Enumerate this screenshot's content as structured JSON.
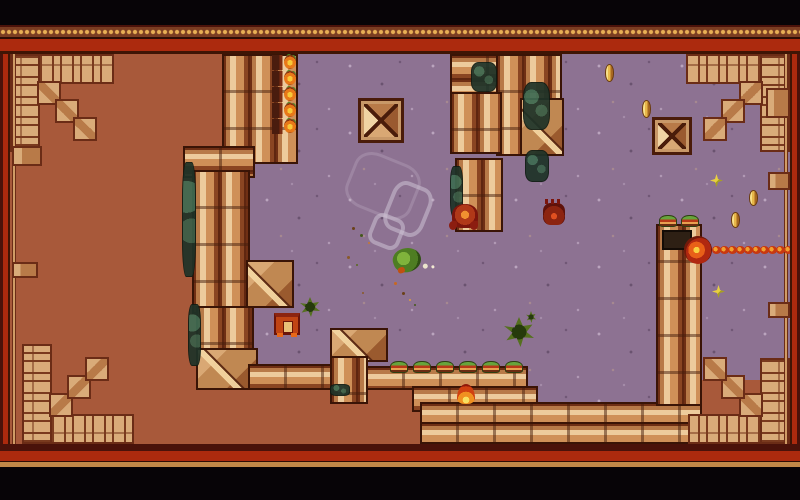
{
  "meta": {
    "kind": "game-screenshot",
    "description": "Top-down pixel-art dungeon arena: purple stone floor bordered by copper pipe walls and an ornamental rug frame, with enemies, coins, pickups and a chain-shooting gate turret.",
    "canvas": {
      "width": 800,
      "height": 500
    }
  },
  "palette": {
    "letterbox": "#070407",
    "frame_red": "#ac2a0e",
    "frame_maroon": "#4a120a",
    "frame_gold": "#c08848",
    "dot_gold": "#e8b055",
    "outside_brown": "#a8593a",
    "floor_purple": "#8d7292",
    "pipe_light": "#edcb9c",
    "pipe_mid": "#cf9058",
    "pipe_dark": "#6f2f14",
    "carpet_tan": "#d9ab79",
    "carpet_outline": "#6b2c16",
    "moss_teal": "#1f3328",
    "enemy_red": "#8c1d10",
    "player_green": "#4e7d22",
    "coin_gold": "#e8b84a",
    "chain_red": "#c83810"
  },
  "viewport": {
    "x": 10,
    "y": 54,
    "w": 780,
    "h": 390,
    "floor_clip": "polygon(286px 0px, 780px 0px, 780px 326px, 688px 326px, 688px 349px, 410px 349px, 410px 330px, 270px 330px, 270px 313px, 235px 313px, 235px 106px, 286px 106px)"
  },
  "frame_bands": {
    "top": [
      {
        "class": "letterbox",
        "y": 0,
        "h": 25
      },
      {
        "class": "band-maroon",
        "y": 25,
        "h": 2
      },
      {
        "class": "band-dots",
        "y": 27,
        "h": 10
      },
      {
        "class": "band-dark",
        "y": 37,
        "h": 2
      },
      {
        "class": "band-red",
        "y": 39,
        "h": 12
      },
      {
        "class": "band-edge",
        "y": 51,
        "h": 3
      }
    ],
    "bottom": [
      {
        "class": "band-maroon",
        "y": 444,
        "h": 7
      },
      {
        "class": "band-red",
        "y": 451,
        "h": 10
      },
      {
        "class": "band-dark",
        "y": 461,
        "h": 1
      },
      {
        "class": "band-gold",
        "y": 462,
        "h": 5
      },
      {
        "class": "letterbox",
        "y": 467,
        "h": 33
      }
    ],
    "left": [
      {
        "class": "band-maroon",
        "x": 0,
        "w": 3
      },
      {
        "class": "band-red",
        "x": 3,
        "w": 5
      },
      {
        "class": "band-edge",
        "x": 8,
        "w": 2
      }
    ],
    "right": [
      {
        "class": "band-edge",
        "x": 790,
        "w": 2
      },
      {
        "class": "band-red",
        "x": 792,
        "w": 5
      },
      {
        "class": "band-maroon",
        "x": 797,
        "w": 3
      }
    ]
  },
  "walls": [
    {
      "type": "v-pipe",
      "name": "wall-pillar-topleft",
      "x": 212,
      "y": 0,
      "w": 76,
      "h": 110
    },
    {
      "type": "h-pipe",
      "name": "wall-step-cap",
      "x": 173,
      "y": 92,
      "w": 72,
      "h": 32
    },
    {
      "type": "v-pipe",
      "name": "wall-left-column",
      "x": 182,
      "y": 116,
      "w": 58,
      "h": 144
    },
    {
      "type": "block-diag",
      "name": "wall-stub-right",
      "x": 236,
      "y": 206,
      "w": 48,
      "h": 48
    },
    {
      "type": "v-pipe",
      "name": "wall-left-column-2",
      "x": 186,
      "y": 252,
      "w": 58,
      "h": 50
    },
    {
      "type": "block-diag",
      "name": "wall-corner-block",
      "x": 186,
      "y": 294,
      "w": 62,
      "h": 42
    },
    {
      "type": "h-pipe",
      "name": "wall-hpipe-left",
      "x": 238,
      "y": 310,
      "w": 88,
      "h": 26
    },
    {
      "type": "block-diag",
      "name": "wall-bracket-arm",
      "x": 320,
      "y": 274,
      "w": 58,
      "h": 34
    },
    {
      "type": "v-pipe",
      "name": "wall-bracket-spine",
      "x": 320,
      "y": 302,
      "w": 38,
      "h": 48
    },
    {
      "type": "h-pipe",
      "name": "wall-hpipe-mid",
      "x": 356,
      "y": 312,
      "w": 162,
      "h": 24
    },
    {
      "type": "h-pipe",
      "name": "wall-lower-cluster",
      "x": 402,
      "y": 332,
      "w": 126,
      "h": 26
    },
    {
      "type": "h-pipe",
      "name": "wall-bottom-row-1",
      "x": 410,
      "y": 348,
      "w": 282,
      "h": 22
    },
    {
      "type": "h-pipe",
      "name": "wall-bottom-row-2",
      "x": 410,
      "y": 368,
      "w": 282,
      "h": 22
    },
    {
      "type": "h-pipe",
      "name": "wall-topright-a",
      "x": 440,
      "y": 0,
      "w": 112,
      "h": 46
    },
    {
      "type": "v-pipe",
      "name": "wall-topright-b",
      "x": 486,
      "y": 0,
      "w": 66,
      "h": 102
    },
    {
      "type": "v-pipe",
      "name": "wall-topright-c",
      "x": 440,
      "y": 38,
      "w": 52,
      "h": 62
    },
    {
      "type": "v-pipe",
      "name": "wall-topright-stub",
      "x": 445,
      "y": 104,
      "w": 48,
      "h": 74
    },
    {
      "type": "block-diag",
      "name": "wall-topright-d",
      "x": 510,
      "y": 44,
      "w": 44,
      "h": 58
    },
    {
      "type": "v-pipe",
      "name": "gate-tower",
      "x": 646,
      "y": 170,
      "w": 46,
      "h": 182
    },
    {
      "type": "crate",
      "name": "pyramid-crate-1",
      "x": 348,
      "y": 44,
      "w": 46,
      "h": 45
    },
    {
      "type": "crate",
      "name": "pyramid-crate-2",
      "x": 642,
      "y": 63,
      "w": 40,
      "h": 38
    }
  ],
  "decor": {
    "corners": [
      {
        "name": "carpet-corner-topleft",
        "x": 0,
        "y": 0,
        "w": 104,
        "h": 98,
        "flip": ""
      },
      {
        "name": "carpet-corner-topright",
        "x": 676,
        "y": 0,
        "w": 104,
        "h": 98,
        "flip": "flip-x"
      },
      {
        "name": "carpet-corner-bottomleft",
        "x": 12,
        "y": 290,
        "w": 112,
        "h": 100,
        "flip": "flip-y"
      },
      {
        "name": "carpet-corner-bottomright",
        "x": 678,
        "y": 304,
        "w": 102,
        "h": 86,
        "flip": "flip-xy"
      }
    ],
    "trims": [
      {
        "kind": "line",
        "name": "carpet-trim-left",
        "x": 3,
        "y": 0,
        "w": 2,
        "h": 390
      },
      {
        "kind": "line",
        "name": "carpet-trim-right",
        "x": 775,
        "y": 0,
        "w": 2,
        "h": 390
      },
      {
        "kind": "box",
        "name": "carpet-ornament",
        "x": 2,
        "y": 92,
        "w": 30,
        "h": 20
      },
      {
        "kind": "box",
        "name": "carpet-ornament",
        "x": 2,
        "y": 208,
        "w": 26,
        "h": 16
      },
      {
        "kind": "box",
        "name": "carpet-ornament",
        "x": 756,
        "y": 34,
        "w": 24,
        "h": 30
      },
      {
        "kind": "box",
        "name": "carpet-ornament",
        "x": 758,
        "y": 118,
        "w": 22,
        "h": 18
      },
      {
        "kind": "box",
        "name": "carpet-ornament",
        "x": 758,
        "y": 248,
        "w": 22,
        "h": 16
      }
    ],
    "moss": [
      {
        "name": "moss-patch",
        "x": 172,
        "y": 108,
        "w": 14,
        "h": 115
      },
      {
        "name": "moss-patch",
        "x": 178,
        "y": 250,
        "w": 13,
        "h": 62
      },
      {
        "name": "moss-patch",
        "x": 461,
        "y": 8,
        "w": 26,
        "h": 30
      },
      {
        "name": "moss-patch",
        "x": 513,
        "y": 28,
        "w": 27,
        "h": 48
      },
      {
        "name": "moss-patch",
        "x": 440,
        "y": 112,
        "w": 13,
        "h": 52
      },
      {
        "name": "moss-patch",
        "x": 515,
        "y": 96,
        "w": 24,
        "h": 32
      },
      {
        "name": "moss-patch",
        "x": 320,
        "y": 330,
        "w": 20,
        "h": 12
      }
    ]
  },
  "entities": [
    {
      "type": "ring faint",
      "name": "smoke-ring-large",
      "x": 338,
      "y": 103,
      "w": 70,
      "h": 58
    },
    {
      "type": "ring",
      "name": "smoke-ring-mid",
      "x": 377,
      "y": 129,
      "w": 42,
      "h": 52
    },
    {
      "type": "ring",
      "name": "smoke-ring-small",
      "x": 360,
      "y": 161,
      "w": 33,
      "h": 33
    },
    {
      "type": "player",
      "name": "player-character",
      "x": 383,
      "y": 194,
      "w": 28,
      "h": 24
    },
    {
      "type": "crab",
      "name": "crab-enemy-1",
      "x": 442,
      "y": 150,
      "w": 26,
      "h": 24
    },
    {
      "type": "crab2",
      "name": "crab-enemy-2",
      "x": 533,
      "y": 149,
      "w": 22,
      "h": 22
    },
    {
      "type": "flame",
      "name": "flame-enemy",
      "x": 447,
      "y": 330,
      "w": 18,
      "h": 20
    },
    {
      "type": "chest",
      "name": "spawner-hut",
      "x": 264,
      "y": 259,
      "w": 26,
      "h": 22
    },
    {
      "type": "splat",
      "name": "green-splat-1",
      "x": 290,
      "y": 243,
      "w": 20,
      "h": 20
    },
    {
      "type": "splat",
      "name": "green-splat-2",
      "x": 494,
      "y": 263,
      "w": 30,
      "h": 30
    },
    {
      "type": "splat",
      "name": "green-splat-2b",
      "x": 516,
      "y": 257,
      "w": 10,
      "h": 12
    },
    {
      "type": "torch",
      "name": "wall-torch",
      "x": 262,
      "y": 1,
      "w": 24,
      "h": 15
    },
    {
      "type": "torch",
      "name": "wall-torch",
      "x": 262,
      "y": 17,
      "w": 24,
      "h": 15
    },
    {
      "type": "torch",
      "name": "wall-torch",
      "x": 262,
      "y": 33,
      "w": 24,
      "h": 15
    },
    {
      "type": "torch",
      "name": "wall-torch",
      "x": 262,
      "y": 49,
      "w": 24,
      "h": 15
    },
    {
      "type": "torch",
      "name": "wall-torch",
      "x": 262,
      "y": 65,
      "w": 24,
      "h": 15
    },
    {
      "type": "cap",
      "name": "pipe-cap",
      "x": 380,
      "y": 307,
      "w": 18,
      "h": 12
    },
    {
      "type": "cap",
      "name": "pipe-cap",
      "x": 403,
      "y": 307,
      "w": 18,
      "h": 12
    },
    {
      "type": "cap",
      "name": "pipe-cap",
      "x": 426,
      "y": 307,
      "w": 18,
      "h": 12
    },
    {
      "type": "cap",
      "name": "pipe-cap",
      "x": 449,
      "y": 307,
      "w": 18,
      "h": 12
    },
    {
      "type": "cap",
      "name": "pipe-cap",
      "x": 472,
      "y": 307,
      "w": 18,
      "h": 12
    },
    {
      "type": "cap",
      "name": "pipe-cap",
      "x": 495,
      "y": 307,
      "w": 18,
      "h": 12
    },
    {
      "type": "cap",
      "name": "tower-cap",
      "x": 649,
      "y": 161,
      "w": 18,
      "h": 12
    },
    {
      "type": "cap",
      "name": "tower-cap",
      "x": 671,
      "y": 161,
      "w": 18,
      "h": 12
    },
    {
      "type": "panel",
      "name": "tower-vent",
      "x": 652,
      "y": 176,
      "w": 30,
      "h": 20
    },
    {
      "type": "gate",
      "name": "chain-gate-turret",
      "x": 674,
      "y": 182,
      "w": 28,
      "h": 28
    },
    {
      "type": "chain-link",
      "name": "chain-link",
      "x": 702,
      "y": 192,
      "w": 9,
      "h": 8
    },
    {
      "type": "chain-link",
      "name": "chain-link",
      "x": 710,
      "y": 192,
      "w": 9,
      "h": 8
    },
    {
      "type": "chain-link",
      "name": "chain-link",
      "x": 718,
      "y": 192,
      "w": 9,
      "h": 8
    },
    {
      "type": "chain-link",
      "name": "chain-link",
      "x": 726,
      "y": 192,
      "w": 9,
      "h": 8
    },
    {
      "type": "chain-link",
      "name": "chain-link",
      "x": 734,
      "y": 192,
      "w": 9,
      "h": 8
    },
    {
      "type": "chain-link",
      "name": "chain-link",
      "x": 742,
      "y": 192,
      "w": 9,
      "h": 8
    },
    {
      "type": "chain-link",
      "name": "chain-link",
      "x": 750,
      "y": 192,
      "w": 9,
      "h": 8
    },
    {
      "type": "chain-link",
      "name": "chain-link",
      "x": 758,
      "y": 192,
      "w": 9,
      "h": 8
    },
    {
      "type": "chain-link",
      "name": "chain-link",
      "x": 766,
      "y": 192,
      "w": 9,
      "h": 8
    },
    {
      "type": "chain-link",
      "name": "chain-link",
      "x": 774,
      "y": 192,
      "w": 9,
      "h": 8
    },
    {
      "type": "coin",
      "name": "gold-coin-1",
      "x": 595,
      "y": 10,
      "w": 9,
      "h": 18
    },
    {
      "type": "coin",
      "name": "gold-coin-2",
      "x": 632,
      "y": 46,
      "w": 9,
      "h": 18
    },
    {
      "type": "coin",
      "name": "gold-coin-3",
      "x": 739,
      "y": 136,
      "w": 9,
      "h": 16
    },
    {
      "type": "coin",
      "name": "gold-coin-4",
      "x": 721,
      "y": 158,
      "w": 9,
      "h": 16
    },
    {
      "type": "star",
      "name": "sparkle-pickup-1",
      "x": 700,
      "y": 120,
      "w": 13,
      "h": 13
    },
    {
      "type": "star",
      "name": "sparkle-pickup-2",
      "x": 702,
      "y": 231,
      "w": 13,
      "h": 13
    },
    {
      "type": "dot",
      "name": "debris",
      "x": 342,
      "y": 173,
      "w": 3,
      "h": 3,
      "color": "#6a4018"
    },
    {
      "type": "dot",
      "name": "debris",
      "x": 350,
      "y": 180,
      "w": 3,
      "h": 3,
      "color": "#44581c"
    },
    {
      "type": "dot",
      "name": "debris",
      "x": 358,
      "y": 188,
      "w": 2,
      "h": 2,
      "color": "#c87830"
    },
    {
      "type": "dot",
      "name": "debris",
      "x": 337,
      "y": 202,
      "w": 3,
      "h": 3,
      "color": "#8a5a28"
    },
    {
      "type": "dot",
      "name": "debris",
      "x": 346,
      "y": 210,
      "w": 2,
      "h": 2,
      "color": "#5a6a20"
    },
    {
      "type": "dot",
      "name": "debris",
      "x": 384,
      "y": 228,
      "w": 3,
      "h": 3,
      "color": "#c86820"
    },
    {
      "type": "dot",
      "name": "debris",
      "x": 392,
      "y": 238,
      "w": 3,
      "h": 3,
      "color": "#6a4018"
    },
    {
      "type": "dot",
      "name": "debris",
      "x": 399,
      "y": 245,
      "w": 2,
      "h": 2,
      "color": "#e0a040"
    },
    {
      "type": "dot",
      "name": "debris",
      "x": 404,
      "y": 250,
      "w": 2,
      "h": 2,
      "color": "#44581c"
    },
    {
      "type": "dot",
      "name": "debris",
      "x": 352,
      "y": 238,
      "w": 2,
      "h": 2,
      "color": "#8a5a28"
    }
  ]
}
